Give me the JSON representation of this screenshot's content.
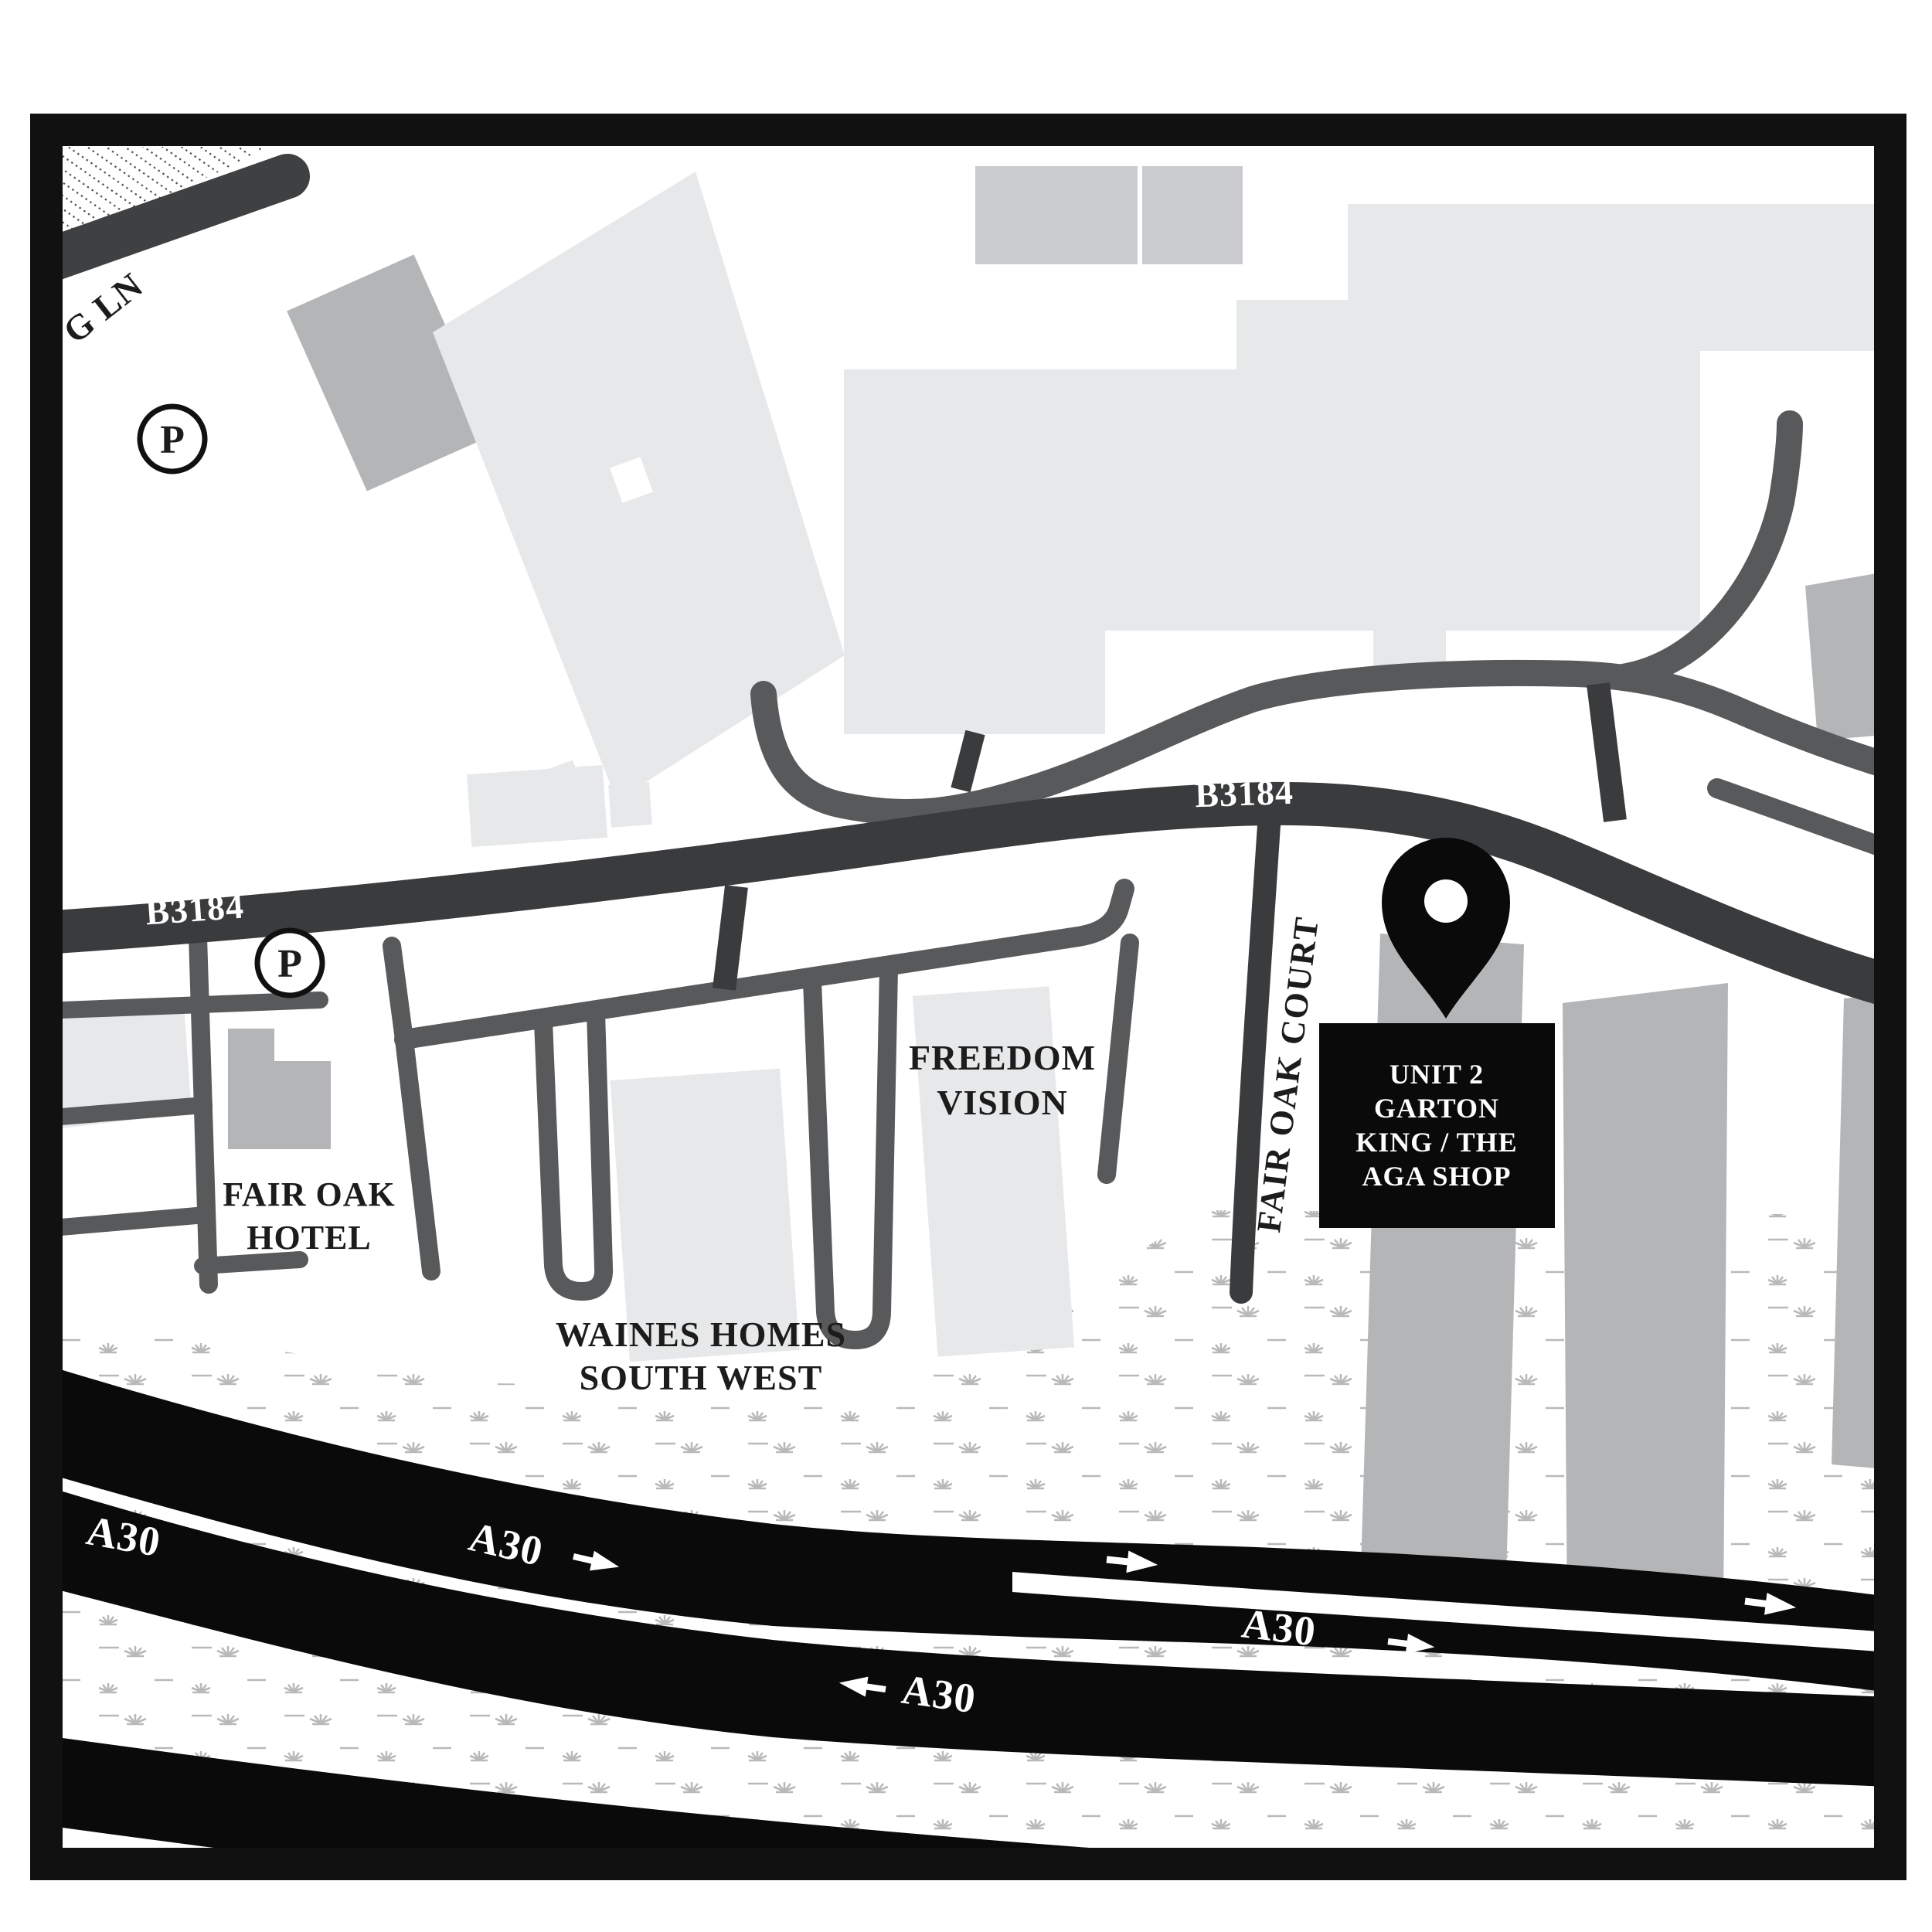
{
  "map": {
    "roads": {
      "b3184_label": "B3184",
      "a30_label": "A30",
      "lane_label": "G LN",
      "fair_oak_court_label": "FAIR OAK COURT"
    },
    "places": {
      "fair_oak_hotel": {
        "line1": "FAIR OAK",
        "line2": "HOTEL"
      },
      "waines_homes": {
        "line1": "WAINES HOMES",
        "line2": "SOUTH WEST"
      },
      "freedom_vision": {
        "line1": "FREEDOM",
        "line2": "VISION"
      }
    },
    "destination": {
      "lines": [
        "UNIT 2",
        "GARTON",
        "KING / THE",
        "AGA SHOP"
      ]
    },
    "parking_symbol": "P",
    "colors": {
      "road_dark": "#3a3b3d",
      "road_medium": "#58595b",
      "building_light": "#e7e8e9",
      "building_medium": "#b3b5b7",
      "building_row": "#c9cbcd",
      "motorway_black": "#0a0a0a",
      "grass": "#b9b9b9",
      "frame": "#111111"
    }
  }
}
